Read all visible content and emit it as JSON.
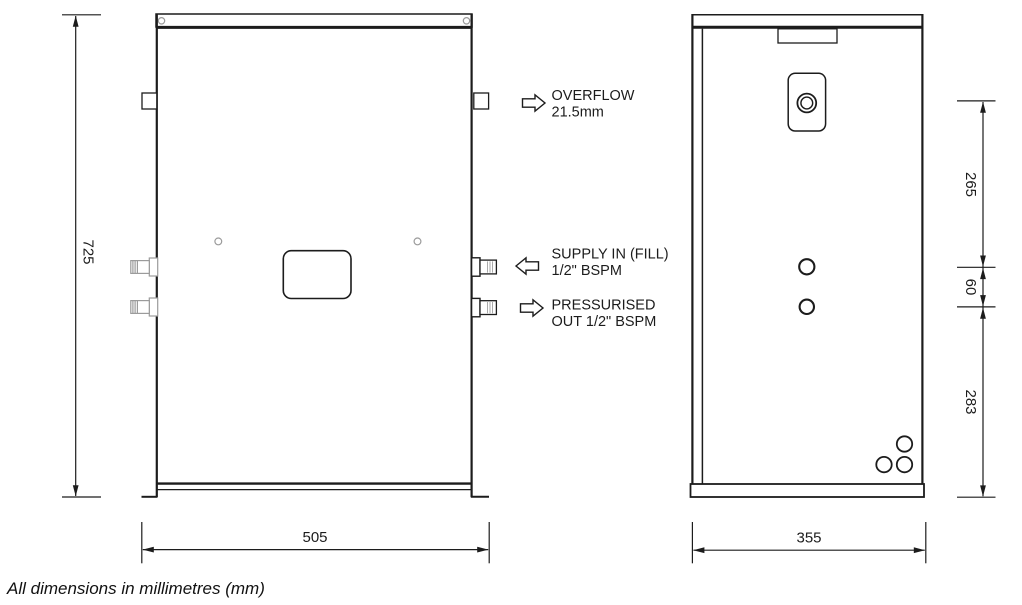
{
  "drawing": {
    "note": "All dimensions in millimetres (mm)",
    "units": "mm"
  },
  "front_view": {
    "label": "front elevation",
    "height_mm": "725",
    "width_mm": "505"
  },
  "side_view": {
    "label": "side elevation",
    "width_mm": "355",
    "upper_section_mm": "265",
    "middle_section_mm": "60",
    "lower_section_mm": "283"
  },
  "callouts": {
    "overflow": {
      "line1": "OVERFLOW",
      "line2": "21.5mm",
      "direction": "right"
    },
    "supply_in": {
      "line1": "SUPPLY IN (FILL)",
      "line2": "1/2\" BSPM",
      "direction": "left"
    },
    "pressurised_out": {
      "line1": "PRESSURISED",
      "line2": "OUT 1/2\" BSPM",
      "direction": "right"
    }
  },
  "colors": {
    "line": "#1c1c1c",
    "gray_detail": "#9b9b9b",
    "background": "#ffffff"
  }
}
